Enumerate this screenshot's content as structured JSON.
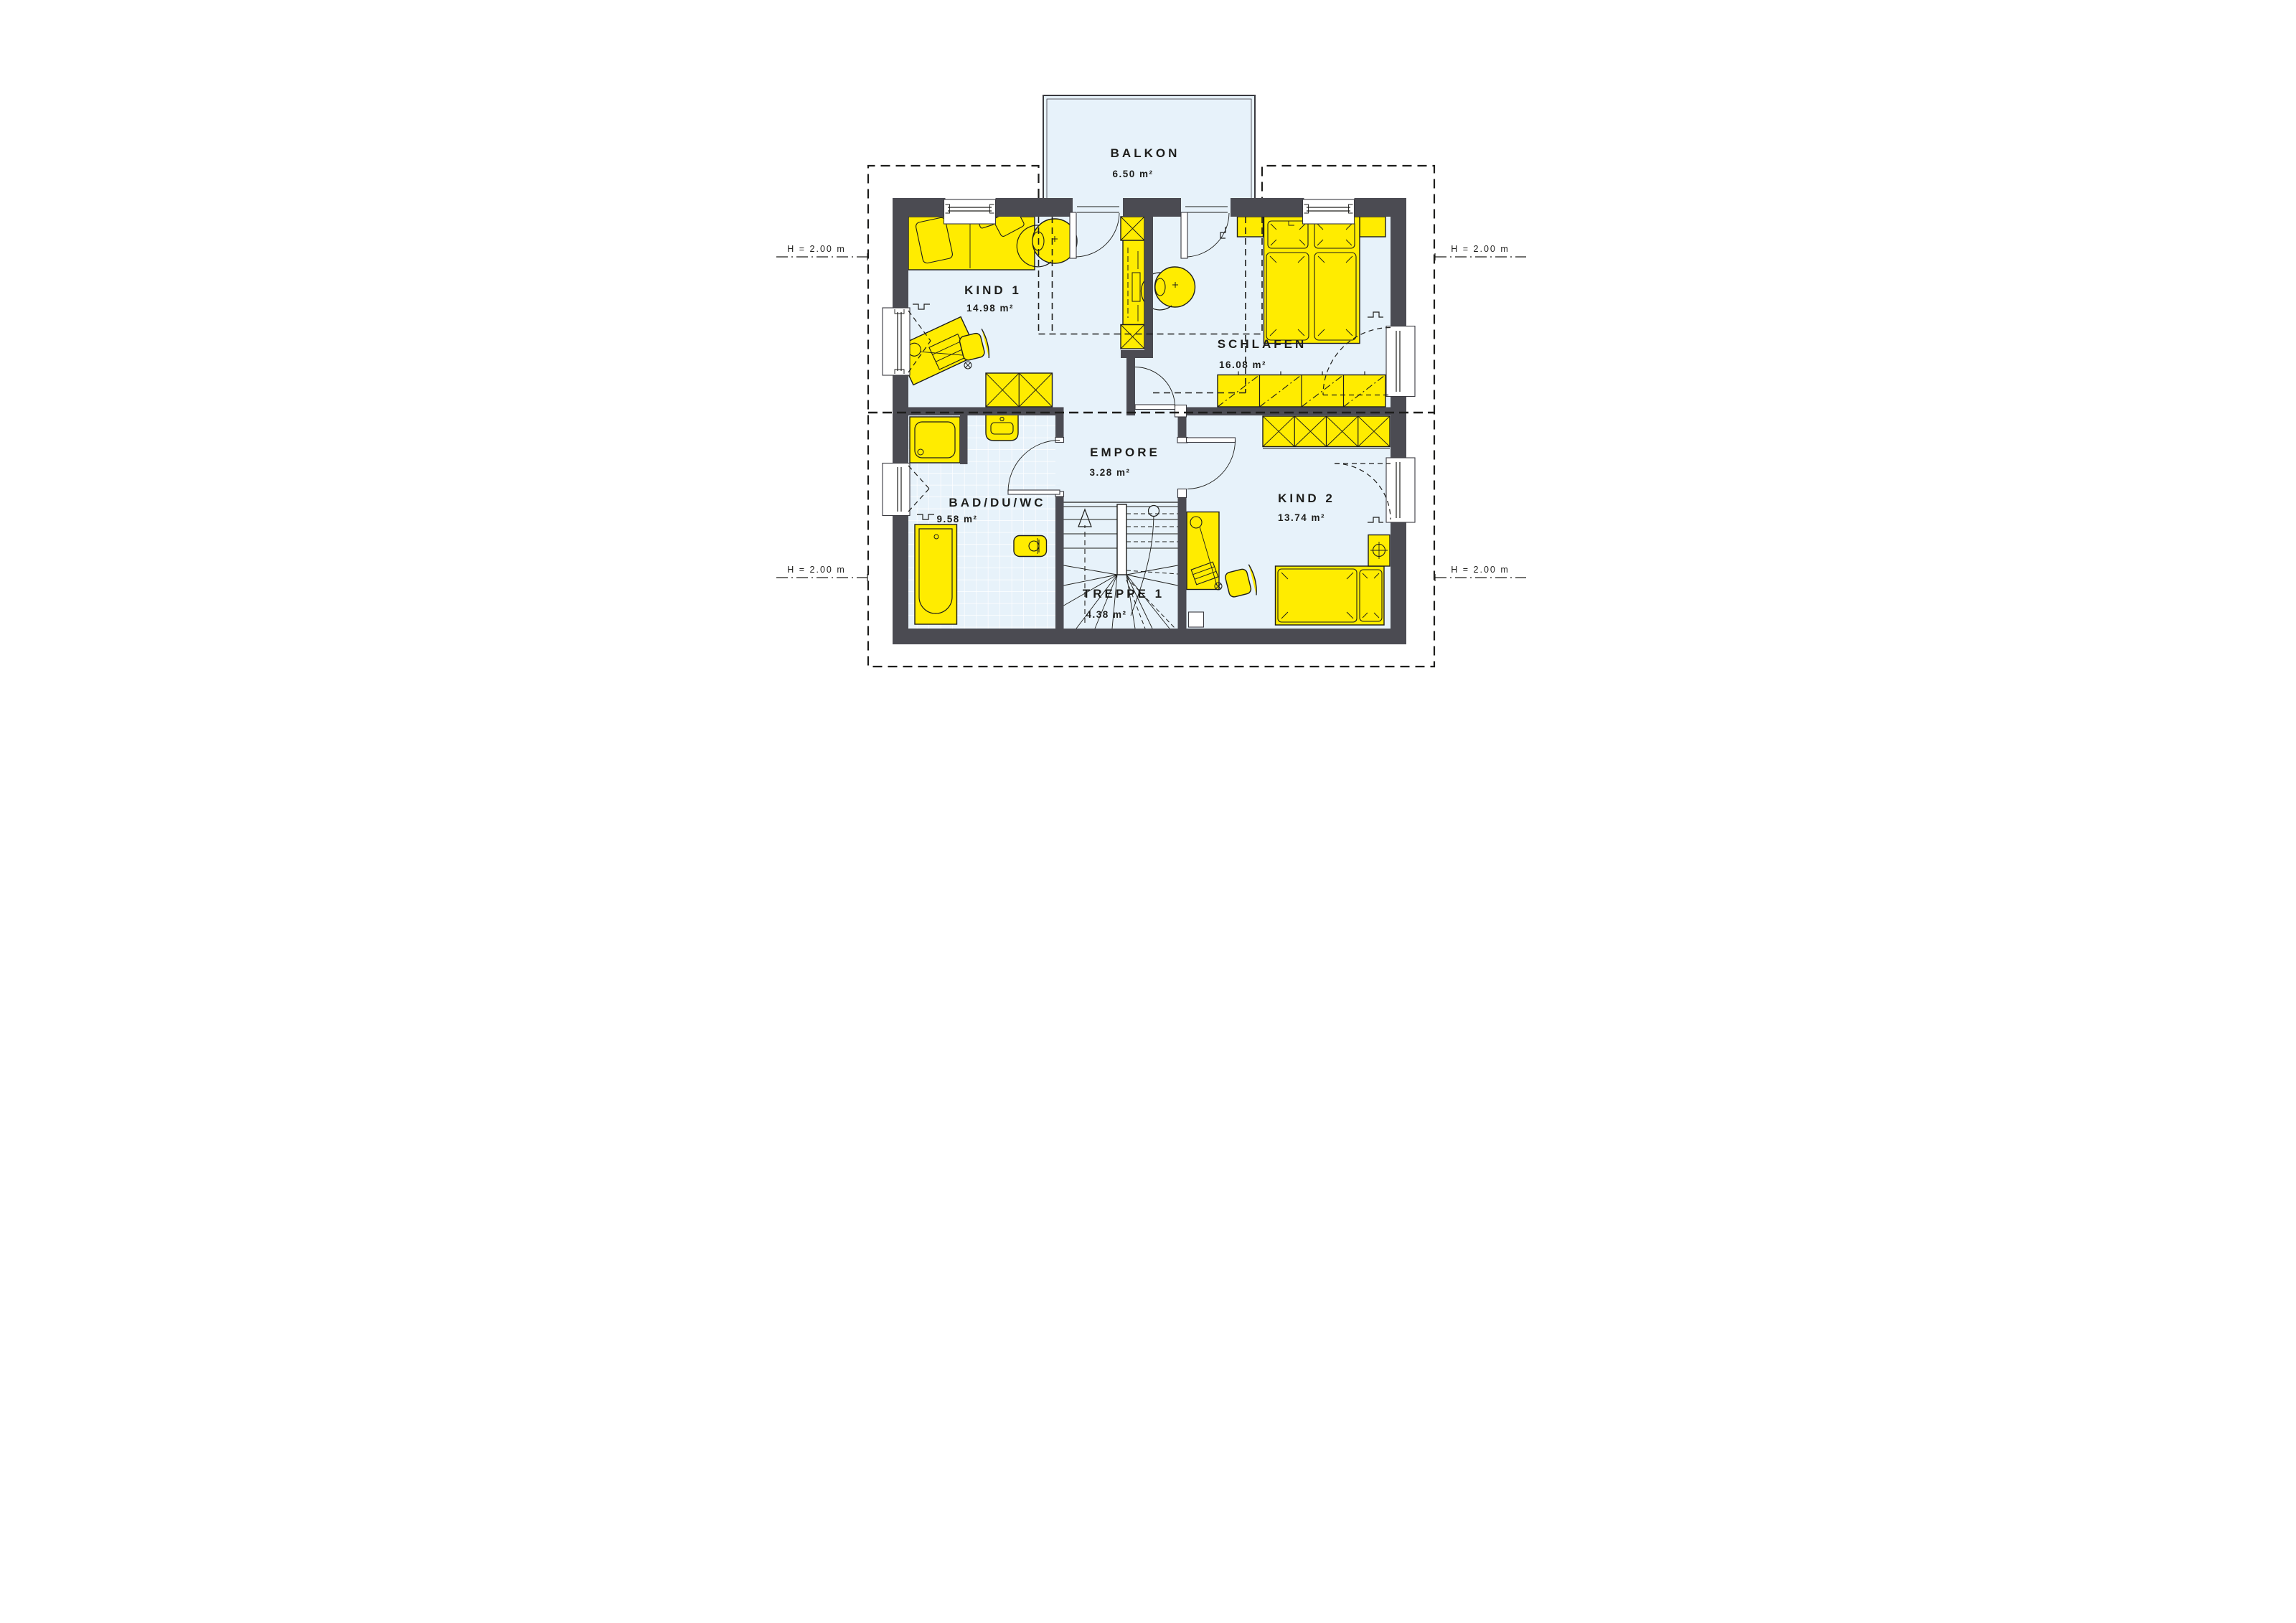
{
  "plan": {
    "type": "floor-plan-upper-storey",
    "rooms": [
      {
        "id": "balkon",
        "name": "BALKON",
        "area": "6.50 m²"
      },
      {
        "id": "kind1",
        "name": "KIND 1",
        "area": "14.98 m²"
      },
      {
        "id": "schlafen",
        "name": "SCHLAFEN",
        "area": "16.08 m²"
      },
      {
        "id": "empore",
        "name": "EMPORE",
        "area": "3.28 m²"
      },
      {
        "id": "bad",
        "name": "BAD/DU/WC",
        "area": "9.58 m²"
      },
      {
        "id": "treppe",
        "name": "TREPPE 1",
        "area": "4.38 m²"
      },
      {
        "id": "kind2",
        "name": "KIND 2",
        "area": "13.74 m²"
      }
    ],
    "height_annotations": [
      {
        "id": "top-left",
        "label": "H = 2.00 m"
      },
      {
        "id": "top-right",
        "label": "H = 2.00 m"
      },
      {
        "id": "bottom-left",
        "label": "H = 2.00 m"
      },
      {
        "id": "bottom-right",
        "label": "H = 2.00 m"
      }
    ],
    "colors": {
      "furniture_yellow": "#ffec00",
      "wall_gray": "#4b4b52",
      "floor_blue": "#e7f2fa",
      "line_black": "#1d1d1b",
      "background": "#ffffff"
    }
  }
}
